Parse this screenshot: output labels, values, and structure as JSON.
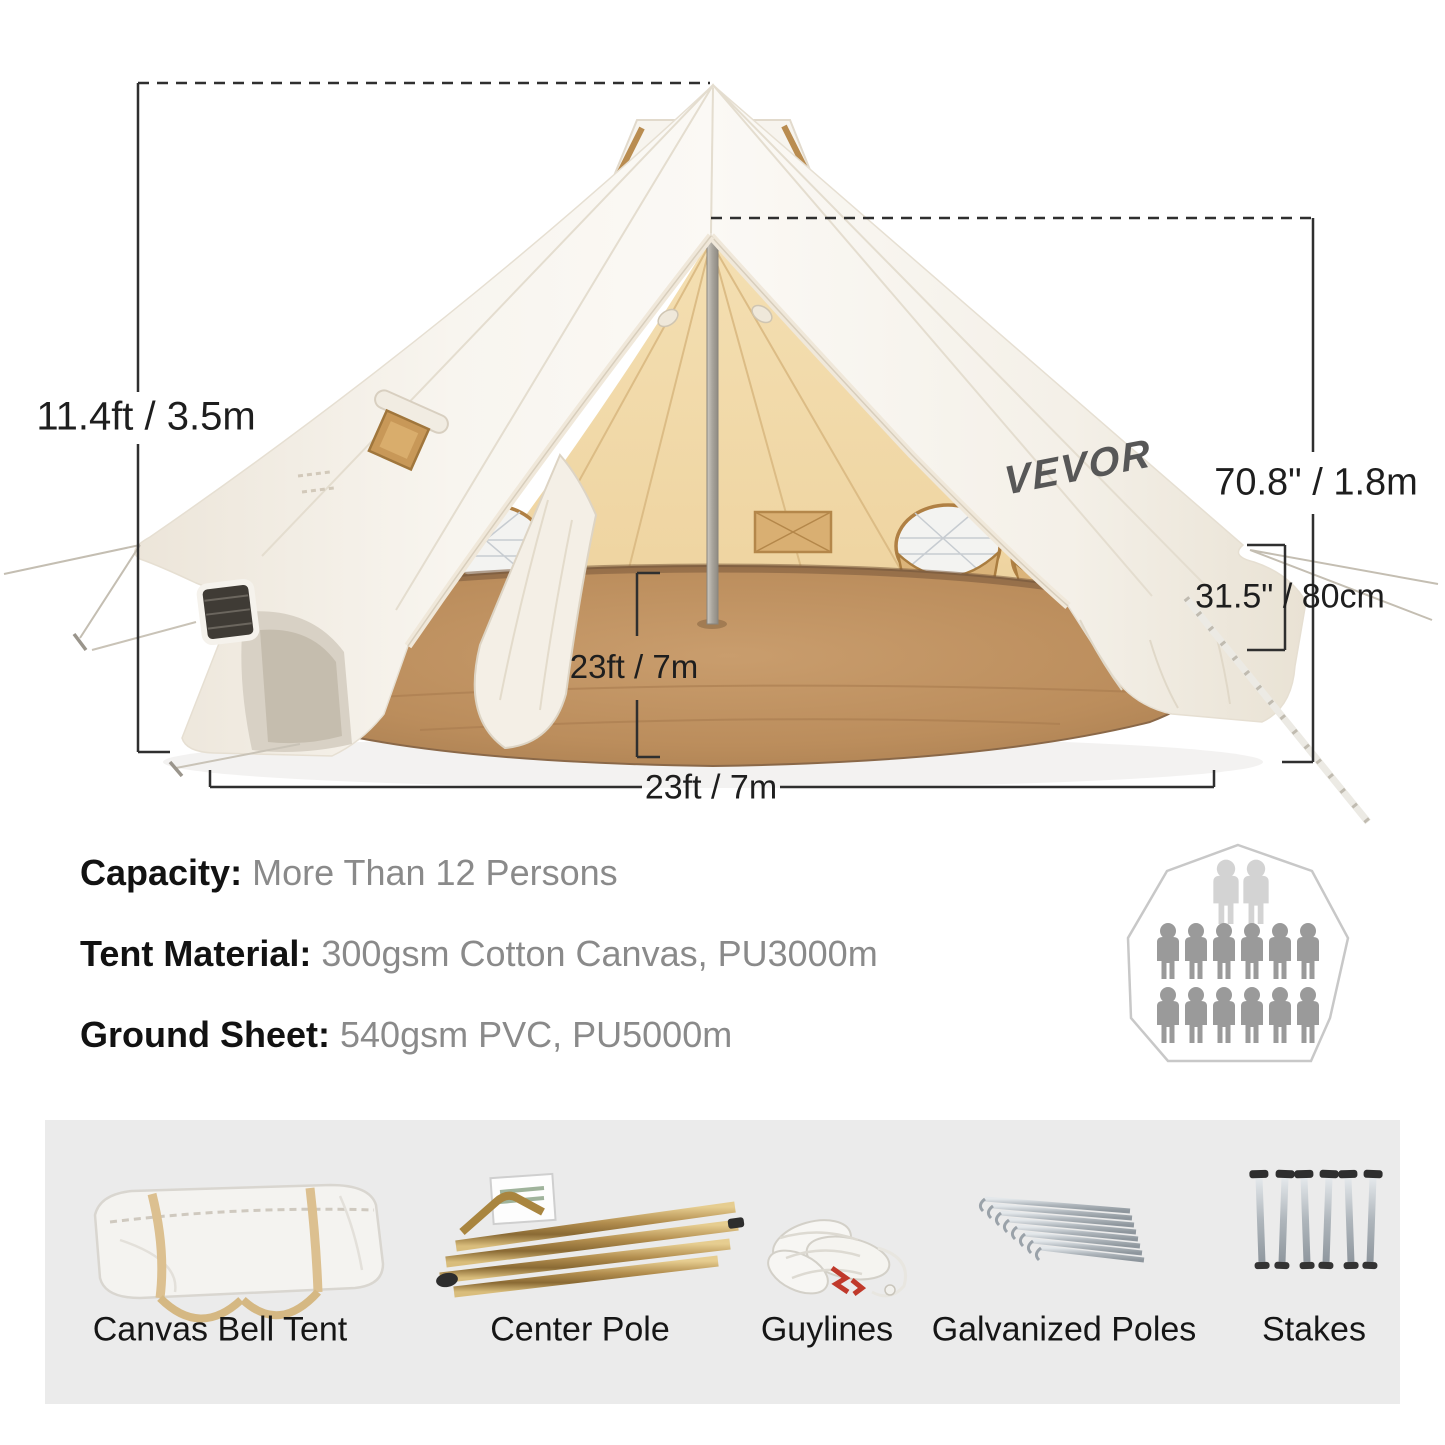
{
  "brand": {
    "logo_text": "VEVOR"
  },
  "tent_annotations": {
    "total_height": "11.4ft / 3.5m",
    "inner_peak_height": "70.8\" / 1.8m",
    "wall_height": "31.5\" / 80cm",
    "floor_diameter": "23ft / 7m",
    "ground_width": "23ft / 7m"
  },
  "specs": [
    {
      "label": "Capacity:",
      "value": "More Than 12 Persons"
    },
    {
      "label": "Tent Material:",
      "value": "300gsm Cotton Canvas, PU3000m"
    },
    {
      "label": "Ground Sheet:",
      "value": "540gsm PVC, PU5000m"
    }
  ],
  "capacity_diagram": {
    "rows": [
      2,
      6,
      6
    ],
    "total_persons": 14,
    "highlight_color": "#d3d3d3",
    "person_color": "#9a9a9a",
    "outline_color": "#c8c8c8"
  },
  "included_items": [
    {
      "label": "Canvas Bell Tent"
    },
    {
      "label": "Center Pole"
    },
    {
      "label": "Guylines"
    },
    {
      "label": "Galvanized Poles"
    },
    {
      "label": "Stakes"
    }
  ],
  "colors": {
    "canvas_white": "#f5f1e9",
    "inner_tent_beige": "#f0d8a8",
    "floor_brown": "#b98a58",
    "dimension_line": "#2f2f2f",
    "spec_value_gray": "#8a8a8a",
    "strip_background": "#ebebeb",
    "logo_gray": "#575757"
  }
}
